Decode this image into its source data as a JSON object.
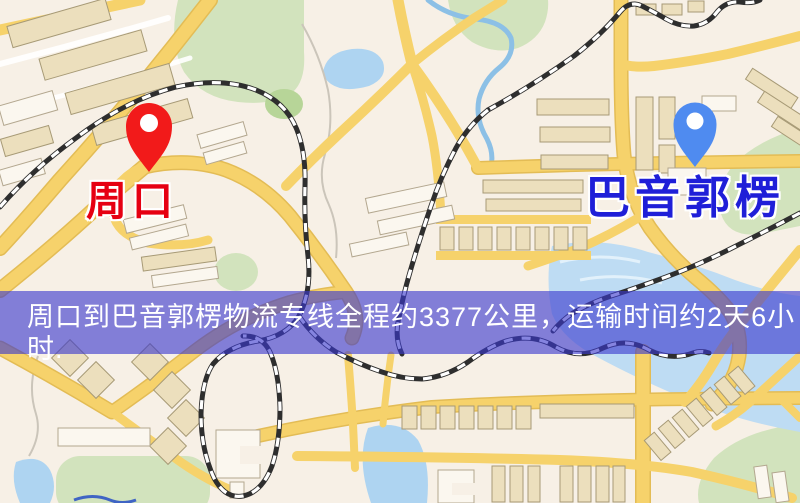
{
  "window": {
    "width": 800,
    "height": 503,
    "kind": "logistics-route-map"
  },
  "map": {
    "markers": [
      {
        "id": "origin",
        "label": "周口",
        "pin_color": "#f21a1a",
        "label_color": "#e60012"
      },
      {
        "id": "destination",
        "label": "巴音郭楞",
        "pin_color": "#4f8bf0",
        "label_color": "#1f1fd8"
      }
    ],
    "palette": {
      "background": "#f7f0e6",
      "road_yellow": "#f6d26b",
      "water_blue": "#aed4f1",
      "park_green": "#d2e3bd",
      "railway_dark": "#2e2e2e",
      "building_tan": "#ecdfbd",
      "building_white": "#fbf7ef"
    }
  },
  "banner": {
    "text": "周口到巴音郭楞物流专线全程约3377公里，运输时间约2天6小时.",
    "origin": "周口",
    "destination": "巴音郭楞",
    "distance_km": "3377",
    "duration": "2天6小时",
    "bg_color": "rgba(58,57,205,0.62)",
    "text_color": "#ffffff"
  }
}
